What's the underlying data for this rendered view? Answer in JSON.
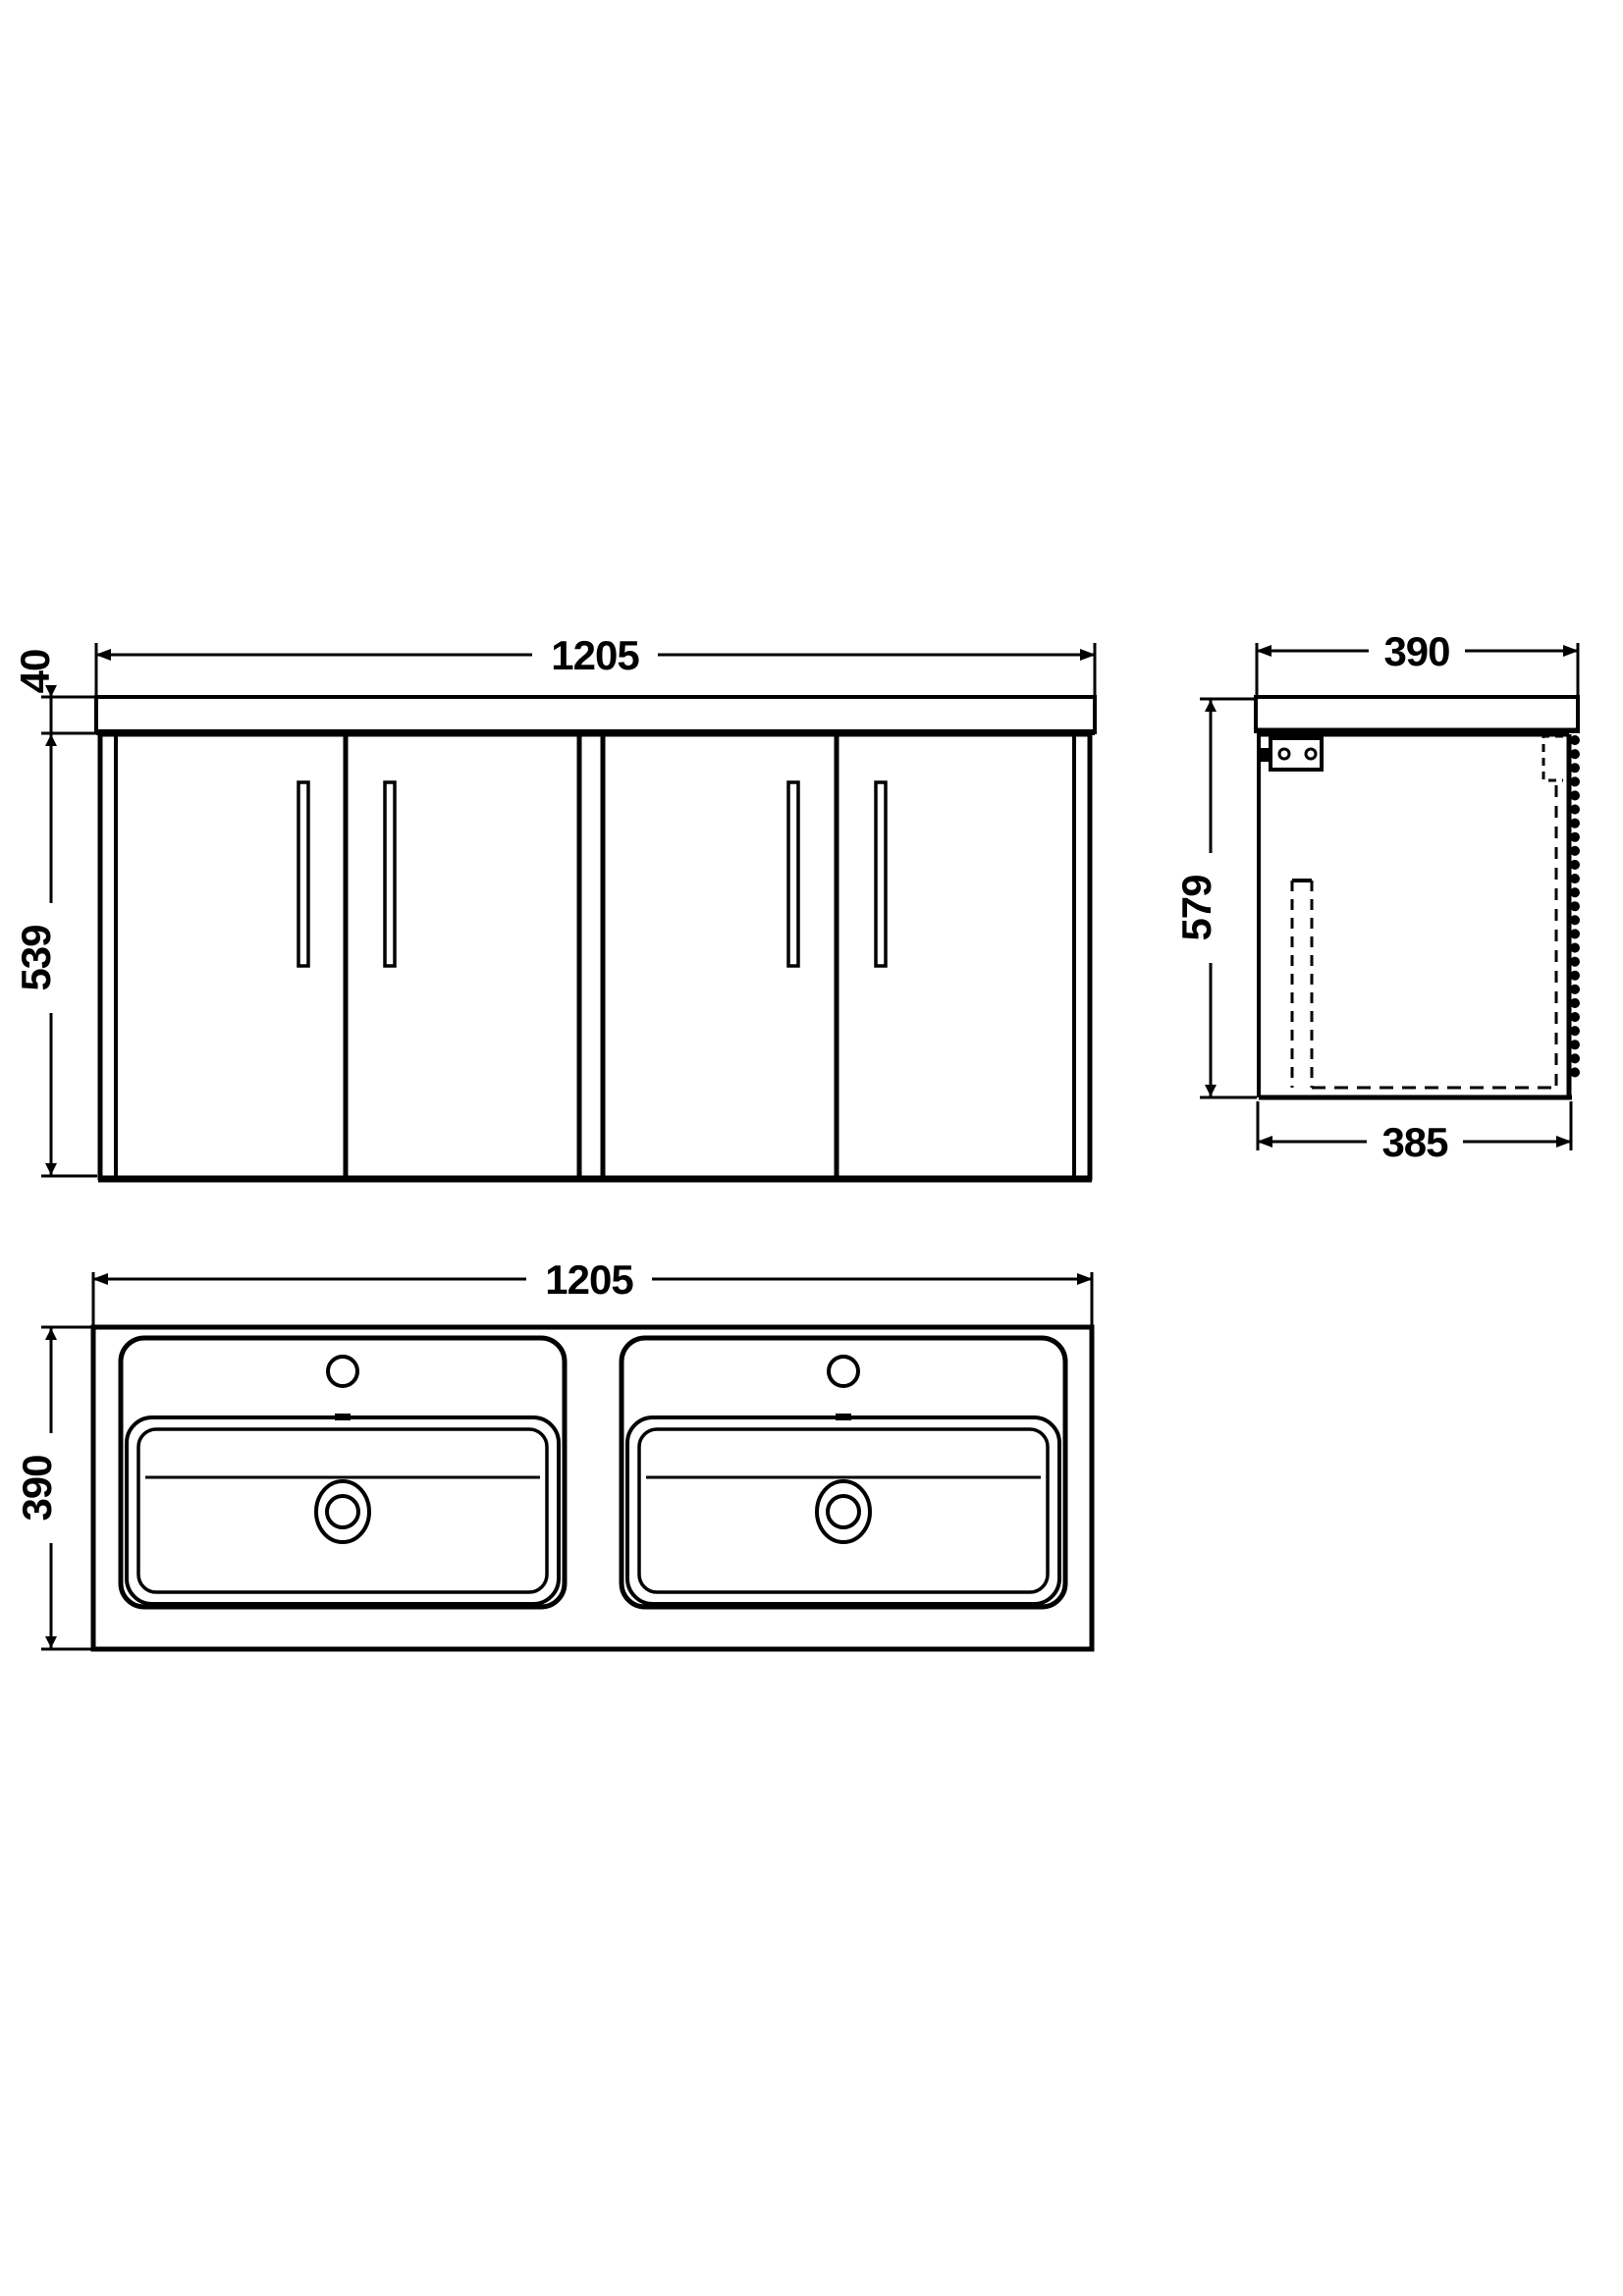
{
  "front_view": {
    "width": "1205",
    "worktop_height": "40",
    "cabinet_height": "539"
  },
  "side_view": {
    "depth": "390",
    "height": "579",
    "base_depth": "385"
  },
  "plan_view": {
    "width": "1205",
    "depth": "390"
  },
  "colors": {
    "line": "#000000",
    "background": "#ffffff"
  }
}
